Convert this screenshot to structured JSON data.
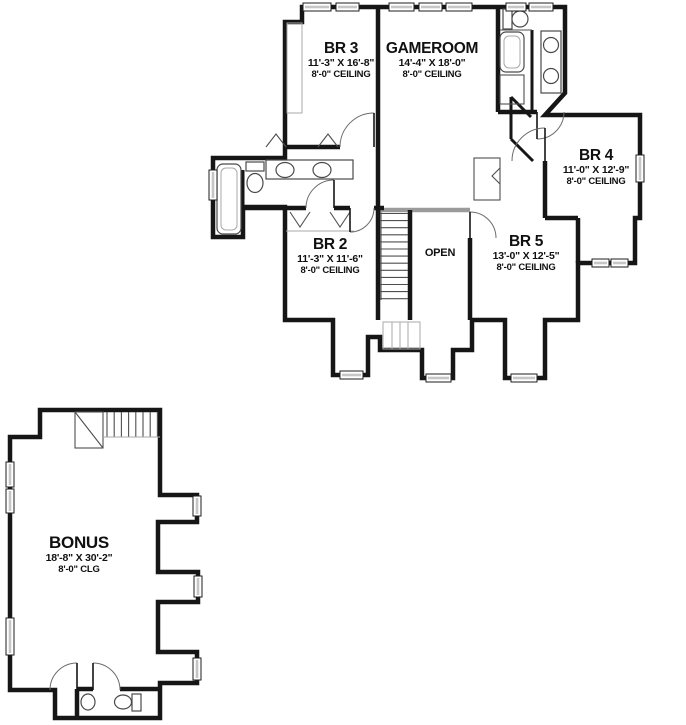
{
  "plan": {
    "title": "two-story floor plan",
    "floors": [
      {
        "name": "second-floor",
        "rooms": [
          {
            "id": "br3",
            "name": "BR 3",
            "dimensions": "11'-3\" X 16'-8\"",
            "ceiling": "8'-0\" CEILING"
          },
          {
            "id": "gameroom",
            "name": "GAMEROOM",
            "dimensions": "14'-4\" X 18'-0\"",
            "ceiling": "8'-0\" CEILING"
          },
          {
            "id": "br4",
            "name": "BR 4",
            "dimensions": "11'-0\" X 12'-9\"",
            "ceiling": "8'-0\" CEILING"
          },
          {
            "id": "br2",
            "name": "BR 2",
            "dimensions": "11'-3\" X 11'-6\"",
            "ceiling": "8'-0\" CEILING"
          },
          {
            "id": "br5",
            "name": "BR 5",
            "dimensions": "13'-0\" X 12'-5\"",
            "ceiling": "8'-0\" CEILING"
          },
          {
            "id": "open",
            "name": "OPEN"
          }
        ]
      },
      {
        "name": "bonus-floor",
        "rooms": [
          {
            "id": "bonus",
            "name": "BONUS",
            "dimensions": "18'-8\" X 30'-2\"",
            "ceiling": "8'-0\" CLG"
          }
        ]
      }
    ],
    "colors": {
      "wall": "#161616",
      "railing": "#9b9b9b",
      "window_fill": "#c6c6c6",
      "background": "#ffffff"
    }
  }
}
